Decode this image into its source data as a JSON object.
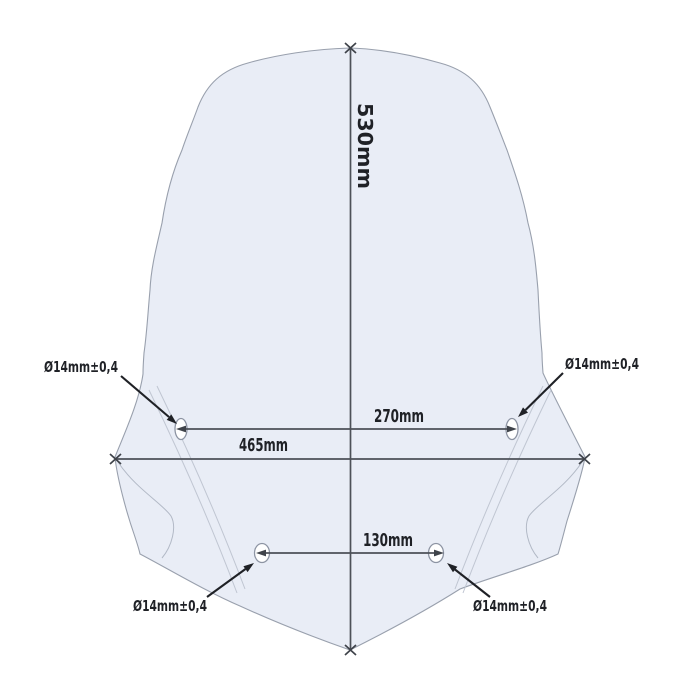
{
  "diagram": {
    "description": "windscreen dimensional drawing",
    "dimensions": {
      "height": "530mm",
      "upper_hole_spacing": "270mm",
      "overall_width": "465mm",
      "lower_hole_spacing": "130mm"
    },
    "hole_callouts": [
      {
        "position": "upper-left",
        "label": "Ø14mm±0,4"
      },
      {
        "position": "upper-right",
        "label": "Ø14mm±0,4"
      },
      {
        "position": "lower-left",
        "label": "Ø14mm±0,4"
      },
      {
        "position": "lower-right",
        "label": "Ø14mm±0,4"
      }
    ],
    "colors": {
      "background": "#ffffff",
      "glass_fill": "#e9edf6",
      "glass_outline": "#99a0ad",
      "inner_lines": "#c0c6d2",
      "dimension_lines": "#4d5158",
      "text": "#1f2126"
    }
  }
}
